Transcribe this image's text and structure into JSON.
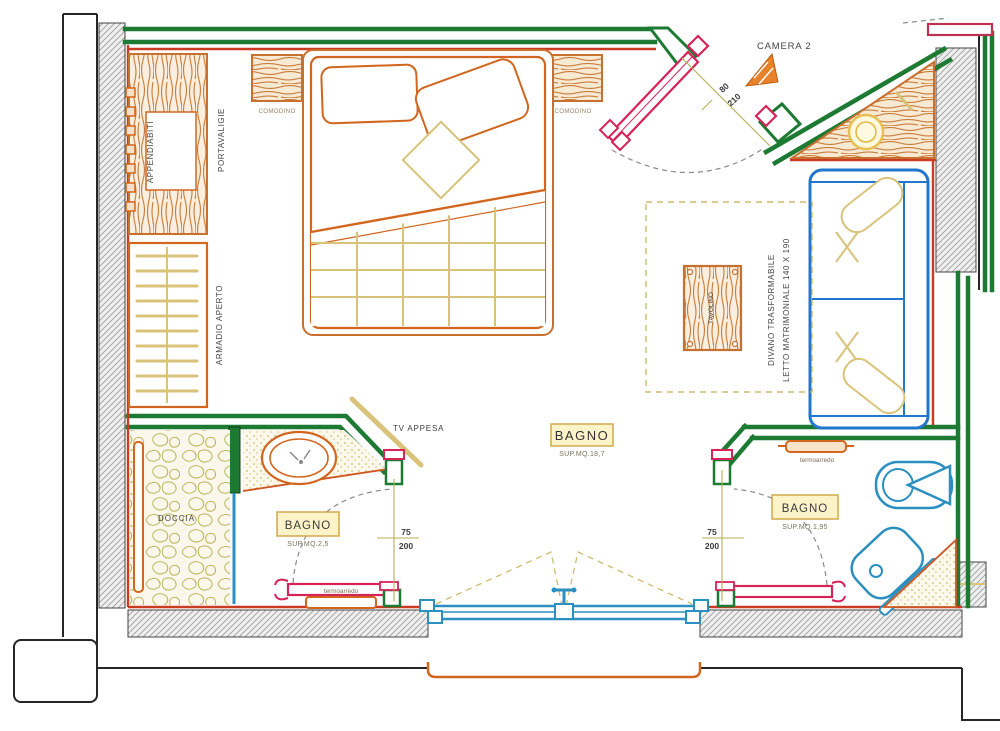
{
  "colors": {
    "wall_green": "#1d7a33",
    "furniture_orange": "#d2661e",
    "detail_tan": "#d9c37a",
    "door_pink": "#d62358",
    "fixture_blue": "#2b8fc0",
    "finish_red": "#cc3a22",
    "label_bg": "#fdf3c9",
    "label_border": "#cfa94a"
  },
  "labels": {
    "camera": "CAMERA 2",
    "appendiabiti": "APPENDIABITI",
    "portavaligie": "PORTAVALIGIE",
    "comodino": "COMODINO",
    "armadio": "ARMADIO APERTO",
    "tavolino": "TAVOLINO",
    "divano_line1": "DIVANO TRASFORMABILE",
    "divano_line2": "LETTO MATRIMONIALE 140 X 190",
    "tv": "TV APPESA",
    "doccia": "DOCCIA",
    "termoarredo": "termoarredo"
  },
  "rooms": {
    "main": {
      "name": "BAGNO",
      "area": "SUP.MQ.18,7"
    },
    "bath_left": {
      "name": "BAGNO",
      "area": "SUP.MQ.2,5"
    },
    "bath_right": {
      "name": "BAGNO",
      "area": "SUP.MQ.1,95"
    }
  },
  "dims": {
    "bath_door_width": "75",
    "bath_door_height": "200",
    "entrance_width": "80",
    "entrance_height": "210"
  }
}
